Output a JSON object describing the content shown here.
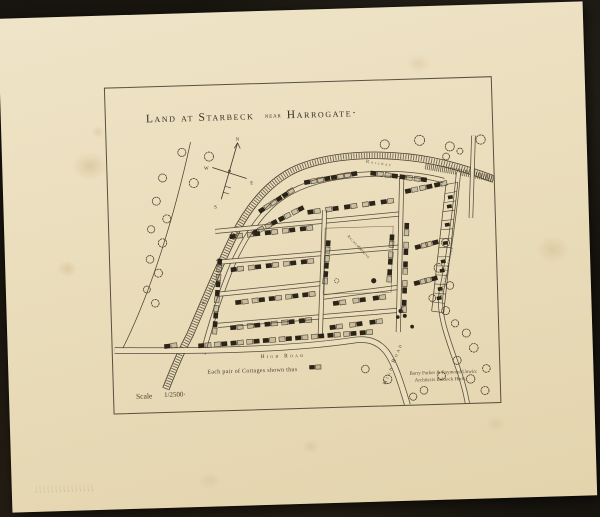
{
  "map": {
    "title": {
      "part1": "Land at Starbeck",
      "near": "near",
      "part2": "Harrogate·"
    },
    "compass": {
      "n": "N",
      "e": "E",
      "s": "S",
      "w": "W"
    },
    "labels": {
      "railway_top": "Railway",
      "railway_left": "Railway",
      "high_road": "High Road",
      "high_road_diagonal": "High Road",
      "existing_cottages": "Existing Cottages",
      "green_line1": "Recreation",
      "green_line2": "Ground"
    },
    "legend_text": "Each pair of Cottages shown thus",
    "scale_label": "Scale",
    "scale_value": "1/2500·",
    "attribution_line1": "Barry Parker & Raymond Unwin:",
    "attribution_line2": "Architects Baldock Herts."
  },
  "colors": {
    "ink": "#453c2d",
    "cottage_fill": "#2a2419",
    "paper": "#eadebc",
    "background": "#18150f"
  }
}
